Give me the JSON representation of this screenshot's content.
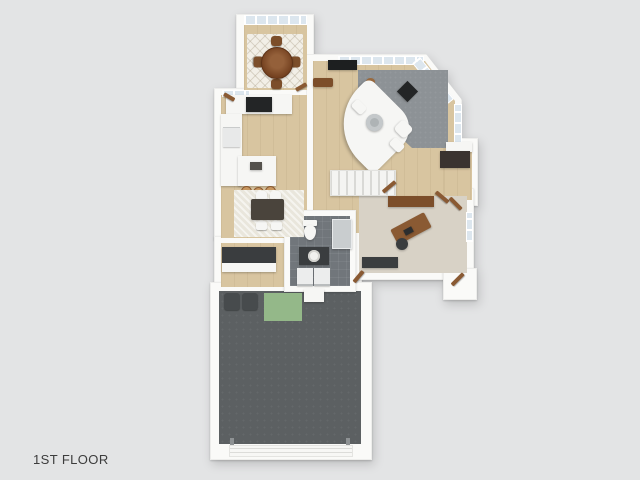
{
  "title": {
    "label": "1ST FLOOR"
  },
  "palette": {
    "bg": "#e3e4e5",
    "wall": "#fafaf8",
    "wood": "#d8c5a0",
    "glass": "#dce6ee",
    "rug-gray": "#8d9296",
    "rug-light": "#e9e6dc",
    "rug-diamond": "#f2efe7",
    "tile": "#71767b",
    "office-floor": "#d8d2c6",
    "garage-floor": "#5c6062",
    "green-mat": "#94b889",
    "furn-white": "#f6f6f4",
    "furn-dark": "#3a3d3f",
    "brown": "#7c4e2a",
    "door-brown": "#8a5a33",
    "stool": "#c7965f",
    "stove-black": "#232526",
    "text": "#3c3c3c"
  },
  "floor_plan": {
    "view": "3d-top-down-render",
    "rooms": [
      {
        "name": "dining-nook",
        "floor": "wood"
      },
      {
        "name": "kitchen",
        "floor": "wood"
      },
      {
        "name": "breakfast-area",
        "floor": "wood"
      },
      {
        "name": "living-room",
        "floor": "wood"
      },
      {
        "name": "stair-hall",
        "floor": "wood"
      },
      {
        "name": "bathroom",
        "floor": "tile"
      },
      {
        "name": "laundry-mudroom",
        "floor": "wood"
      },
      {
        "name": "home-office",
        "floor": "carpet"
      },
      {
        "name": "garage",
        "floor": "concrete"
      },
      {
        "name": "entry",
        "floor": "wood"
      }
    ],
    "furniture": [
      {
        "name": "round-dining-table"
      },
      {
        "name": "dining-chairs",
        "count": 4
      },
      {
        "name": "kitchen-island"
      },
      {
        "name": "bar-stools",
        "count": 3
      },
      {
        "name": "range"
      },
      {
        "name": "refrigerator"
      },
      {
        "name": "breakfast-table"
      },
      {
        "name": "breakfast-chairs",
        "count": 4
      },
      {
        "name": "sectional-sofa"
      },
      {
        "name": "coffee-table"
      },
      {
        "name": "ottoman"
      },
      {
        "name": "tv"
      },
      {
        "name": "media-bench"
      },
      {
        "name": "wood-stove"
      },
      {
        "name": "window-bench"
      },
      {
        "name": "staircase"
      },
      {
        "name": "toilet"
      },
      {
        "name": "vanity-sink"
      },
      {
        "name": "shower"
      },
      {
        "name": "washer"
      },
      {
        "name": "dryer"
      },
      {
        "name": "laundry-counter"
      },
      {
        "name": "desk"
      },
      {
        "name": "desk-chair"
      },
      {
        "name": "console"
      },
      {
        "name": "storage-bins",
        "count": 2
      },
      {
        "name": "work-mat"
      },
      {
        "name": "garage-door"
      }
    ]
  }
}
